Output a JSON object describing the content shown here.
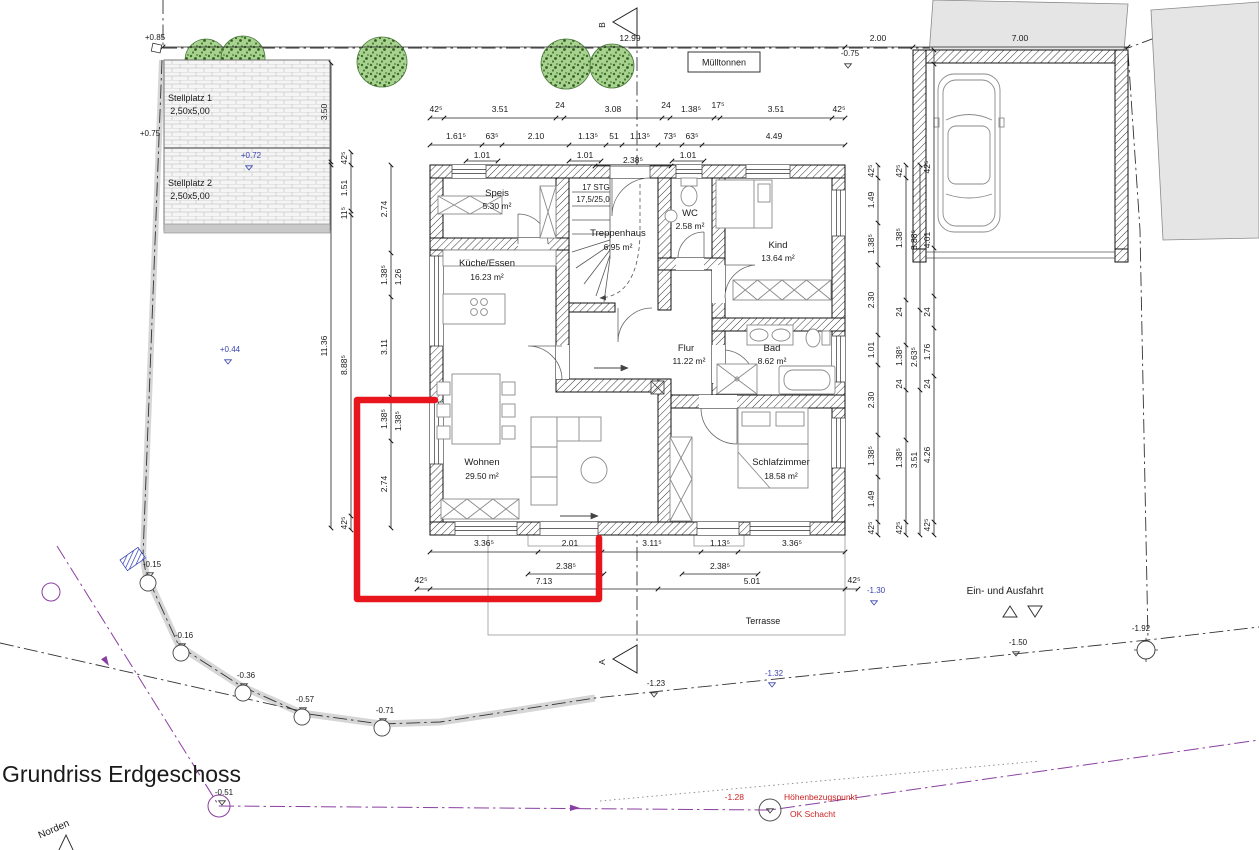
{
  "title": "Grundriss Erdgeschoss",
  "north": "Norden",
  "labels": {
    "muelltonnen": "Mülltonnen",
    "terrasse": "Terrasse",
    "ein_aus": "Ein- und Ausfahrt",
    "hbz1": "Höhenbezugspunkt",
    "hbz2": "OK Schacht",
    "stellplatz1": "Stellplatz 1",
    "stellplatz1_size": "2,50x5,00",
    "stellplatz2": "Stellplatz 2",
    "stellplatz2_size": "2,50x5,00"
  },
  "rooms": {
    "speis": {
      "name": "Speis",
      "area": "5.30 m²"
    },
    "treppenhaus": {
      "name": "Treppenhaus",
      "area": "6.95 m²",
      "stg": "17 STG",
      "ratio": "17,5/25,0"
    },
    "wc": {
      "name": "WC",
      "area": "2.58 m²"
    },
    "kind": {
      "name": "Kind",
      "area": "13.64 m²"
    },
    "kueche": {
      "name": "Küche/Essen",
      "area": "16.23 m²"
    },
    "flur": {
      "name": "Flur",
      "area": "11.22 m²"
    },
    "bad": {
      "name": "Bad",
      "area": "8.62 m²"
    },
    "wohnen": {
      "name": "Wohnen",
      "area": "29.50 m²"
    },
    "schlafzimmer": {
      "name": "Schlafzimmer",
      "area": "18.58 m²"
    }
  },
  "sections": {
    "top": "B",
    "bottom": "A"
  },
  "elevations": {
    "p085": "+0.85",
    "p075": "+0.75",
    "p072": "+0.72",
    "p044": "+0.44",
    "m075": "-0.75",
    "m015": "-0.15",
    "m016": "-0.16",
    "m036": "-0.36",
    "m057": "-0.57",
    "m071": "-0.71",
    "m051": "-0.51",
    "m123": "-1.23",
    "m132": "-1.32",
    "m130": "-1.30",
    "m150": "-1.50",
    "m192": "-1.92",
    "m128": "-1.28"
  },
  "dims": {
    "top_overall": [
      "12.99",
      "2.00",
      "7.00"
    ],
    "top_row1": [
      "42⁵",
      "3.51",
      "24",
      "3.08",
      "24",
      "1.38⁵",
      "17⁵",
      "3.51",
      "42⁵"
    ],
    "top_row2": [
      "1.61⁵",
      "63⁵",
      "2.10",
      "1.13⁵",
      "51",
      "1.13⁵",
      "73⁵",
      "63⁵",
      "4.49"
    ],
    "top_row3": [
      "1.01",
      "1.01",
      "2.38⁵",
      "1.01"
    ],
    "bottom_row1": [
      "3.36⁵",
      "2.01",
      "3.11⁵",
      "1.13⁵",
      "3.36⁵"
    ],
    "bottom_row2": [
      "2.38⁵",
      "2.38⁵"
    ],
    "bottom_row3": [
      "42⁵",
      "7.13",
      "5.01",
      "42⁵"
    ],
    "left_outer": [
      "3.50",
      "11.36"
    ],
    "left_chain1": [
      "42⁵",
      "1.51",
      "11⁵",
      "8.88⁵",
      "42⁵"
    ],
    "left_chain2": [
      "2.74",
      "1.38⁵",
      "1.26",
      "3.11",
      "1.38⁵",
      "1.38⁵",
      "2.74"
    ],
    "right_chain1": [
      "42⁵",
      "1.49",
      "1.38⁵",
      "2.30",
      "1.01",
      "2.30",
      "1.38⁵",
      "1.49",
      "42⁵"
    ],
    "right_chain2": [
      "42⁵",
      "1.38⁵",
      "24",
      "1.38⁵",
      "24",
      "1.38⁵",
      "42⁵"
    ],
    "right_chain3": [
      "3.88⁵",
      "2.63⁵",
      "3.51"
    ],
    "right_chain4": [
      "42⁵",
      "4.01",
      "24",
      "1.76",
      "24",
      "4.26",
      "42⁵"
    ]
  },
  "colors": {
    "highlight_red": "#e8151d",
    "boundary_purple": "#8a3fa0",
    "elevation_blue": "#3a45b0",
    "marker_red": "#cc2222",
    "tree_green": "#a8d290"
  }
}
